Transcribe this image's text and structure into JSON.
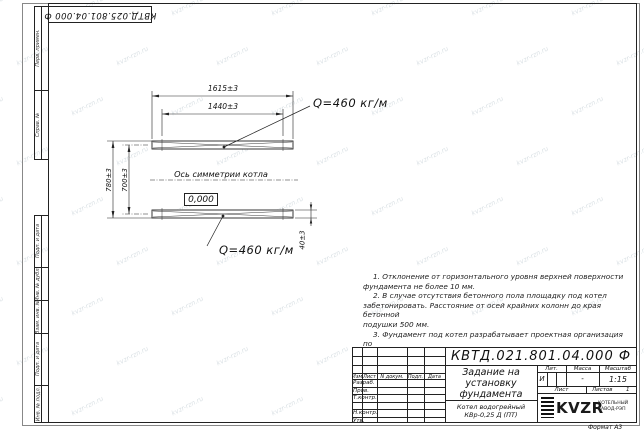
{
  "stamp_top": "КВТД.025.801.04.000 Ф",
  "frame": {
    "top_labels": [
      "Перв. примен.",
      "Справ. №"
    ],
    "bottom_labels": [
      "Подп. и дата",
      "Инв. № дубл.",
      "Взам. инв. №",
      "Подп. и дата",
      "Инв. № подл."
    ],
    "format_note": "Формат А3"
  },
  "drawing": {
    "dims": {
      "length_outer": "1615±3",
      "length_inner": "1440±3",
      "height_outer": "780±3",
      "height_inner": "700±3",
      "rail_height": "40±3"
    },
    "load_top": "Q=460 кг/м",
    "load_bottom": "Q=460 кг/м",
    "axis_label": "Ось симметрии котла",
    "level_mark": "0,000"
  },
  "notes": {
    "lines": [
      "1. Отклонение от горизонтального уровня верхней поверхности",
      "фундамента не более 10 мм.",
      "2. В случае отсутствия бетонного пола площадку под котел",
      "забетонировать. Расстояние от осей крайних колонн до края бетонной",
      "подушки 500 мм.",
      "3. Фундамент под котел разрабатывает проектная организация по",
      "нагрузкам на фундамент."
    ]
  },
  "title_block": {
    "doc_number": "КВТД.021.801.04.000 Ф",
    "title_lines": [
      "Задание на",
      "установку",
      "фундамента"
    ],
    "product_lines": [
      "Котел водогрейный",
      "КВр-0,25 Д (ПТ)"
    ],
    "rev_headers": [
      "Изм.",
      "Лист",
      "N докум.",
      "Подп.",
      "Дата"
    ],
    "row_labels": [
      "Разраб.",
      "Пров.",
      "Т.контр.",
      "Н.контр.",
      "Утв."
    ],
    "lit_label": "Лит.",
    "lit_value": "И",
    "mass_label": "Масса",
    "mass_value": "-",
    "scale_label": "Масштаб",
    "scale_value": "1:15",
    "sheet_label": "Лист",
    "sheets_label": "Листов",
    "sheets_value": "1",
    "logo_text": "KVZR",
    "logo_sub1": "КОТЕЛЬНЫЙ",
    "logo_sub2": "ЗАВОД-РЭП"
  },
  "watermark": {
    "text": "kvzr-rzn.ru"
  }
}
